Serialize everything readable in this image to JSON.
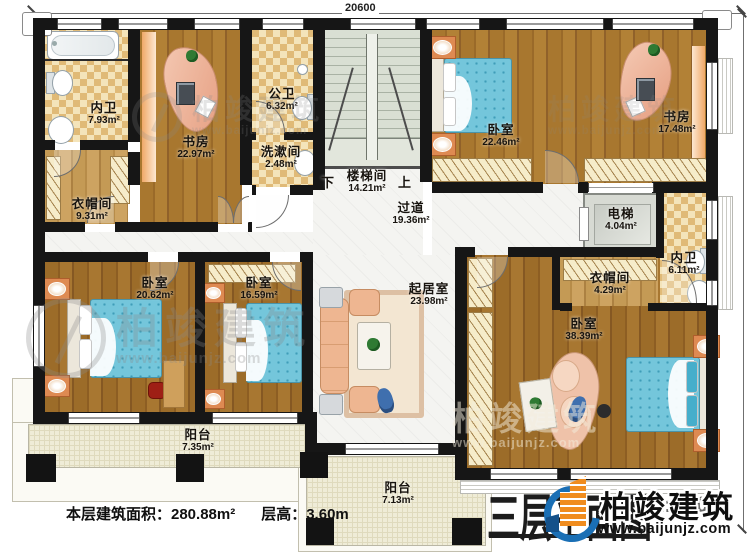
{
  "plan": {
    "dimensions": {
      "width_label": "20600",
      "height_label": "15500"
    },
    "rooms": {
      "neiwei_tl": {
        "name": "内卫",
        "area": "7.93m²"
      },
      "shufang_l": {
        "name": "书房",
        "area": "22.97m²"
      },
      "gongwei": {
        "name": "公卫",
        "area": "6.32m²"
      },
      "xishujian": {
        "name": "洗漱间",
        "area": "2.48m²"
      },
      "yimaojian_l": {
        "name": "衣帽间",
        "area": "9.31m²"
      },
      "woshi_tr": {
        "name": "卧室",
        "area": "22.46m²"
      },
      "shufang_r": {
        "name": "书房",
        "area": "17.48m²"
      },
      "dianti": {
        "name": "电梯",
        "area": "4.04m²"
      },
      "neiwei_r": {
        "name": "内卫",
        "area": "6.11m²"
      },
      "yimaojian_r": {
        "name": "衣帽间",
        "area": "4.29m²"
      },
      "guodao": {
        "name": "过道",
        "area": "19.36m²"
      },
      "qijushi": {
        "name": "起居室",
        "area": "23.98m²"
      },
      "woshi_bl": {
        "name": "卧室",
        "area": "20.62m²"
      },
      "woshi_bm": {
        "name": "卧室",
        "area": "16.59m²"
      },
      "woshi_master": {
        "name": "卧室",
        "area": "38.39m²"
      },
      "yangtai_l": {
        "name": "阳台",
        "area": "7.35m²"
      },
      "yangtai_c": {
        "name": "阳台",
        "area": "7.13m²"
      }
    },
    "stairs": {
      "name": "楼梯间",
      "area": "14.21m²",
      "down": "下",
      "up": "上"
    },
    "footer": {
      "area_text": "本层建筑面积：280.88m²",
      "height_text": "层高：3.60m"
    },
    "title_block": {
      "title": "三层平面图",
      "scale": "1:100",
      "company": "柏竣建筑",
      "website": "www.baijunjz.com"
    },
    "watermark": {
      "company": "柏竣建筑",
      "website": "www.baijunjz.com"
    }
  }
}
